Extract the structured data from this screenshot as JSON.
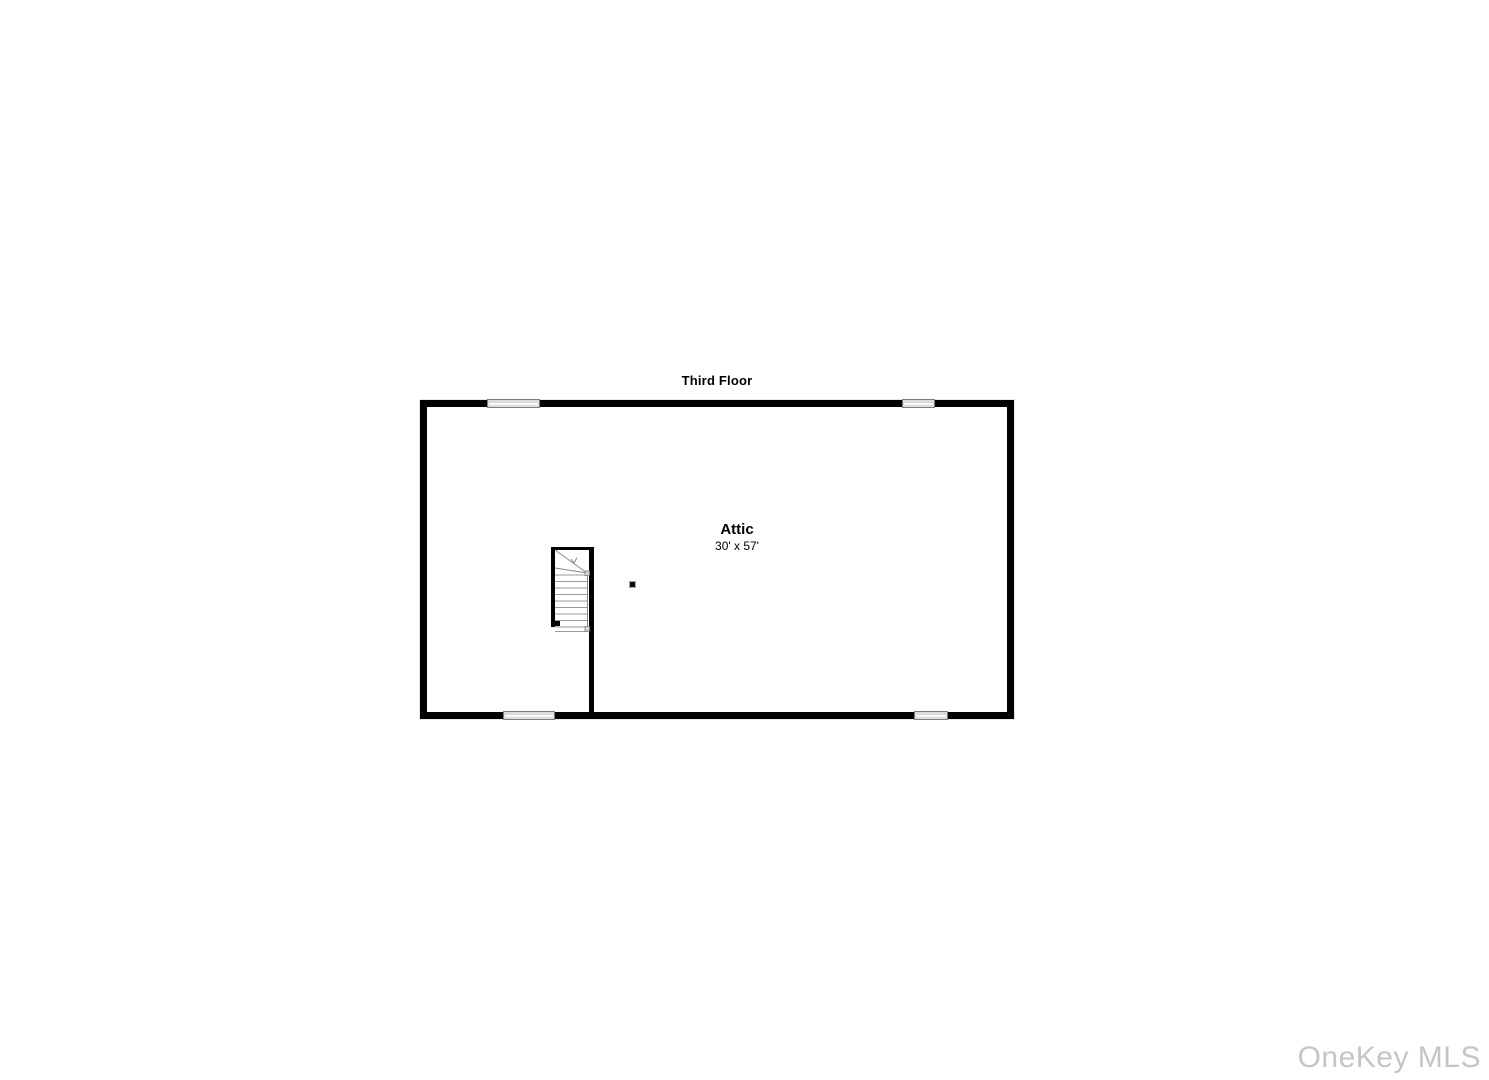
{
  "floorplan": {
    "title": "Third Floor",
    "room": {
      "name": "Attic",
      "dimensions": "30' x 57'"
    },
    "symbols": {
      "windows": [
        "window-top-left",
        "window-top-right",
        "window-bottom-left",
        "window-bottom-right"
      ],
      "staircase": "winder-staircase-icon",
      "column": "support-column-marker"
    },
    "colors": {
      "wall": "#000000",
      "window_fill": "#dcdcdc",
      "window_border": "#7d7d7d",
      "stair_tread_line": "#9a9a9a",
      "background": "#ffffff"
    }
  },
  "watermark": {
    "text": "OneKey MLS",
    "color": "#c5c5c5"
  }
}
